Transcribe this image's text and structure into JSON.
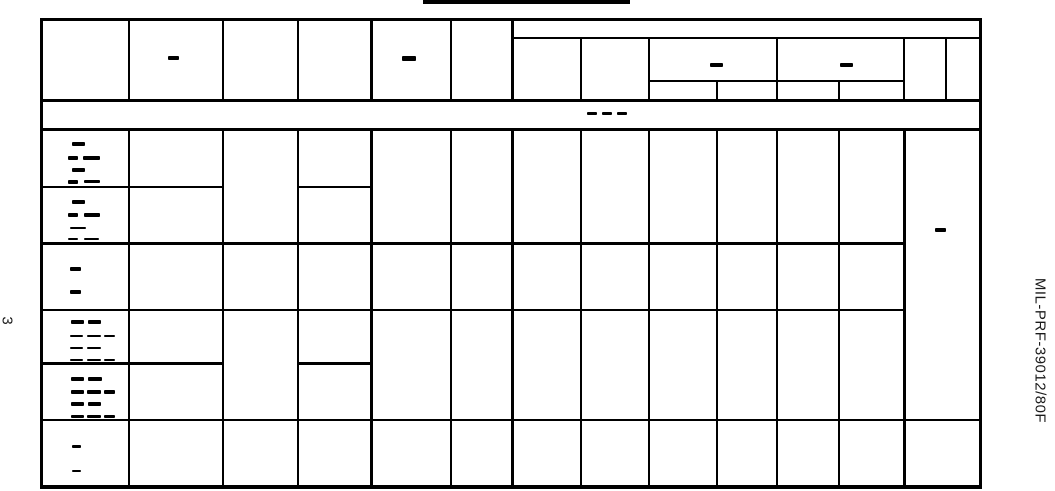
{
  "page": {
    "page_number": "3",
    "doc_id": "MIL-PRF-39012/80F"
  },
  "colors": {
    "ink": "#000000",
    "paper": "#ffffff"
  },
  "marks": [
    {
      "name": "header-col2-dash",
      "x": 168,
      "y": 56,
      "w": 11,
      "h": 4
    },
    {
      "name": "header-col5-dash",
      "x": 402,
      "y": 56,
      "w": 14,
      "h": 5
    },
    {
      "name": "header-group1-dash",
      "x": 710,
      "y": 63,
      "w": 13,
      "h": 4
    },
    {
      "name": "header-group2-dash",
      "x": 840,
      "y": 63,
      "w": 13,
      "h": 4
    },
    {
      "name": "spanner-dash-1",
      "x": 587,
      "y": 112,
      "w": 10,
      "h": 3
    },
    {
      "name": "spanner-dash-2",
      "x": 602,
      "y": 112,
      "w": 10,
      "h": 3
    },
    {
      "name": "spanner-dash-3",
      "x": 617,
      "y": 112,
      "w": 10,
      "h": 3
    },
    {
      "name": "notes-cell-dash",
      "x": 935,
      "y": 228,
      "w": 11,
      "h": 4
    },
    {
      "name": "row1-label-dash",
      "x": 72,
      "y": 142,
      "w": 13,
      "h": 4
    },
    {
      "name": "row1-label-dash",
      "x": 68,
      "y": 156,
      "w": 10,
      "h": 4
    },
    {
      "name": "row1-label-dash",
      "x": 83,
      "y": 156,
      "w": 17,
      "h": 4
    },
    {
      "name": "row1-label-dash",
      "x": 72,
      "y": 168,
      "w": 13,
      "h": 4
    },
    {
      "name": "row1-label-dash",
      "x": 68,
      "y": 180,
      "w": 10,
      "h": 4
    },
    {
      "name": "row1-label-dash",
      "x": 84,
      "y": 180,
      "w": 16,
      "h": 3
    },
    {
      "name": "row2-label-dash",
      "x": 72,
      "y": 200,
      "w": 13,
      "h": 4
    },
    {
      "name": "row2-label-dash",
      "x": 68,
      "y": 213,
      "w": 10,
      "h": 4
    },
    {
      "name": "row2-label-dash",
      "x": 84,
      "y": 213,
      "w": 16,
      "h": 4
    },
    {
      "name": "row2-label-dash",
      "x": 70,
      "y": 227,
      "w": 16,
      "h": 2
    },
    {
      "name": "row2-label-dash",
      "x": 68,
      "y": 238,
      "w": 10,
      "h": 2
    },
    {
      "name": "row2-label-dash",
      "x": 84,
      "y": 238,
      "w": 15,
      "h": 2
    },
    {
      "name": "row3-label-dash",
      "x": 70,
      "y": 267,
      "w": 11,
      "h": 4
    },
    {
      "name": "row3-label-dash",
      "x": 70,
      "y": 290,
      "w": 11,
      "h": 4
    },
    {
      "name": "row4-label-dash",
      "x": 71,
      "y": 320,
      "w": 13,
      "h": 4
    },
    {
      "name": "row4-label-dash",
      "x": 88,
      "y": 320,
      "w": 13,
      "h": 4
    },
    {
      "name": "row4-label-dash",
      "x": 70,
      "y": 335,
      "w": 13,
      "h": 2
    },
    {
      "name": "row4-label-dash",
      "x": 87,
      "y": 335,
      "w": 14,
      "h": 2
    },
    {
      "name": "row4-label-dash",
      "x": 104,
      "y": 335,
      "w": 11,
      "h": 2
    },
    {
      "name": "row4-label-dash",
      "x": 70,
      "y": 347,
      "w": 13,
      "h": 2
    },
    {
      "name": "row4-label-dash",
      "x": 87,
      "y": 347,
      "w": 14,
      "h": 2
    },
    {
      "name": "row4-label-dash",
      "x": 70,
      "y": 359,
      "w": 13,
      "h": 2
    },
    {
      "name": "row4-label-dash",
      "x": 87,
      "y": 359,
      "w": 14,
      "h": 2
    },
    {
      "name": "row4-label-dash",
      "x": 104,
      "y": 359,
      "w": 11,
      "h": 2
    },
    {
      "name": "row5-label-dash",
      "x": 71,
      "y": 377,
      "w": 13,
      "h": 4
    },
    {
      "name": "row5-label-dash",
      "x": 88,
      "y": 377,
      "w": 14,
      "h": 4
    },
    {
      "name": "row5-label-dash",
      "x": 71,
      "y": 390,
      "w": 13,
      "h": 4
    },
    {
      "name": "row5-label-dash",
      "x": 87,
      "y": 390,
      "w": 14,
      "h": 4
    },
    {
      "name": "row5-label-dash",
      "x": 104,
      "y": 390,
      "w": 11,
      "h": 4
    },
    {
      "name": "row5-label-dash",
      "x": 71,
      "y": 402,
      "w": 13,
      "h": 4
    },
    {
      "name": "row5-label-dash",
      "x": 88,
      "y": 402,
      "w": 13,
      "h": 4
    },
    {
      "name": "row5-label-dash",
      "x": 71,
      "y": 415,
      "w": 13,
      "h": 3
    },
    {
      "name": "row5-label-dash",
      "x": 87,
      "y": 415,
      "w": 14,
      "h": 3
    },
    {
      "name": "row5-label-dash",
      "x": 104,
      "y": 415,
      "w": 11,
      "h": 3
    },
    {
      "name": "row6-label-dash",
      "x": 72,
      "y": 445,
      "w": 9,
      "h": 3
    },
    {
      "name": "row6-label-dash",
      "x": 72,
      "y": 470,
      "w": 9,
      "h": 2
    }
  ]
}
